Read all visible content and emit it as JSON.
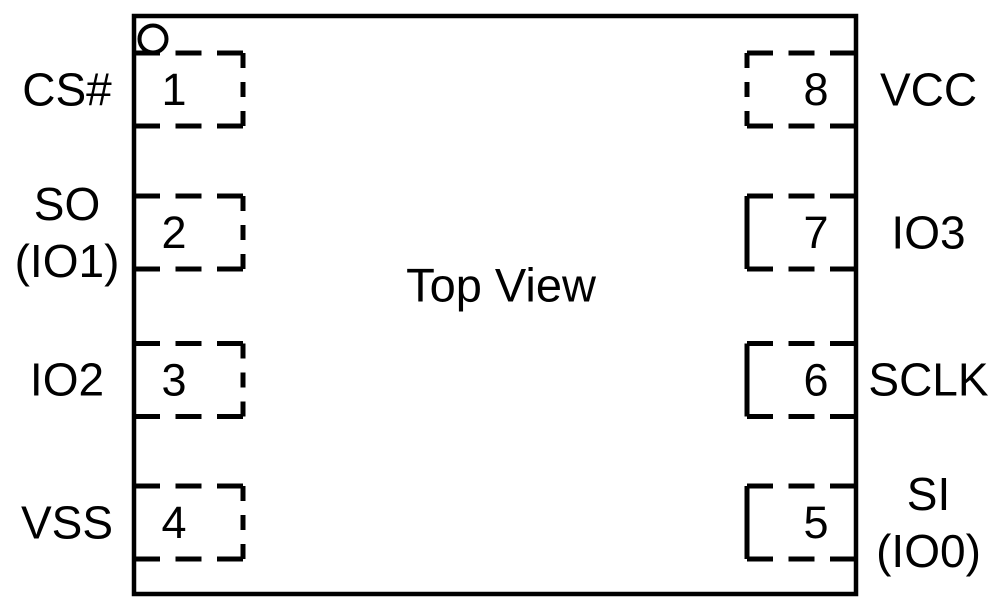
{
  "diagram": {
    "title": "Top View",
    "package_type": "8-pad package top view",
    "pin1_indicator": "circle",
    "colors": {
      "line": "#000000",
      "background": "#ffffff"
    },
    "pins": [
      {
        "number": "1",
        "side": "left",
        "row": 0,
        "label_lines": [
          "CS#"
        ]
      },
      {
        "number": "2",
        "side": "left",
        "row": 1,
        "label_lines": [
          "SO",
          "(IO1)"
        ]
      },
      {
        "number": "3",
        "side": "left",
        "row": 2,
        "label_lines": [
          "IO2"
        ]
      },
      {
        "number": "4",
        "side": "left",
        "row": 3,
        "label_lines": [
          "VSS"
        ]
      },
      {
        "number": "5",
        "side": "right",
        "row": 3,
        "label_lines": [
          "SI",
          "(IO0)"
        ]
      },
      {
        "number": "6",
        "side": "right",
        "row": 2,
        "label_lines": [
          "SCLK"
        ]
      },
      {
        "number": "7",
        "side": "right",
        "row": 1,
        "label_lines": [
          "IO3"
        ]
      },
      {
        "number": "8",
        "side": "right",
        "row": 0,
        "label_lines": [
          "VCC"
        ]
      }
    ]
  }
}
